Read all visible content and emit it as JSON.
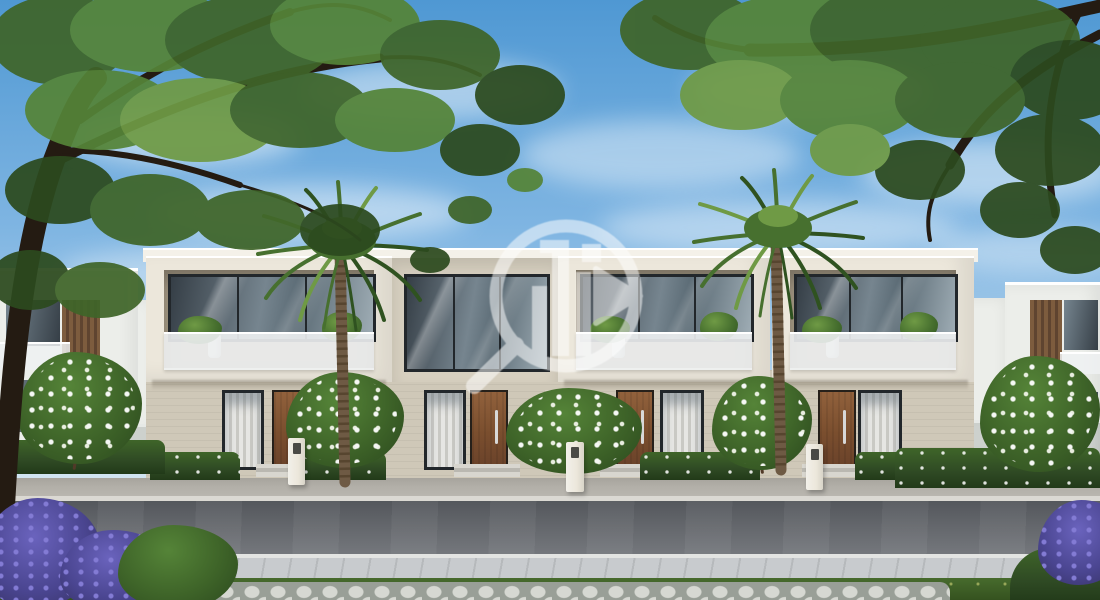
{
  "scene": {
    "title": "Modern two-storey townhouse row - daytime architectural render",
    "watermark": {
      "icon": "magnifier-building-watermark",
      "color": "#ffffff",
      "opacity": 0.52
    }
  },
  "palette": {
    "sky_top": "#4f98d3",
    "sky_mid": "#7fb5e2",
    "sky_low": "#cfe3f2",
    "cloud": "#ffffff",
    "canopy_dark": "#2c4a1e",
    "canopy_mid": "#3f6529",
    "canopy_light": "#558438",
    "canopy_pale": "#6f9a45",
    "branch": "#241b12",
    "palm_dark": "#2f5220",
    "palm_mid": "#47702f",
    "palm_light": "#6f9a45",
    "palm_trunk": "#6e5a44",
    "palm_trunk_dark": "#57452f",
    "facade_white": "#ece7db",
    "facade_light": "#f4f1e9",
    "facade_tan": "#d6cfbf",
    "wall_low": "#cfc8b8",
    "recess": "#a89c87",
    "glass_dark": "#353e46",
    "glass_mid": "#76858f",
    "glass_pale": "#9fadb5",
    "frame_dark": "#22272b",
    "curtain": "#e6e6e3",
    "curtain_shadow": "#c9c9c4",
    "door_wood": "#91613c",
    "door_wood_dark": "#6a422a",
    "metal": "#d8d8d8",
    "step": "#d8d6cf",
    "step_dark": "#bab8b1",
    "sidewalk": "#b2afa8",
    "curb": "#dbd9d3",
    "road": "#63666b",
    "road_dark": "#54575c",
    "road_light": "#74777c",
    "walk_paver": "#c8cbce",
    "grass": "#476b2d",
    "grass_dark": "#35521f",
    "hex_base": "#999f97",
    "hex_stone": "#d6d8d2",
    "hedge": "#2f4a24",
    "hedge_dark": "#223a19",
    "flower_white": "#ffffff",
    "purple": "#4a4590",
    "purple_light": "#837bd4",
    "purple_deep": "#34305f",
    "bgwall": "#cdd1cd",
    "bg_house": "#eceeea",
    "wood_slat": "#7d5c3e",
    "wood_slat_dark": "#5f4430",
    "trunk_small": "#513a28",
    "watermark": "#ffffff"
  }
}
